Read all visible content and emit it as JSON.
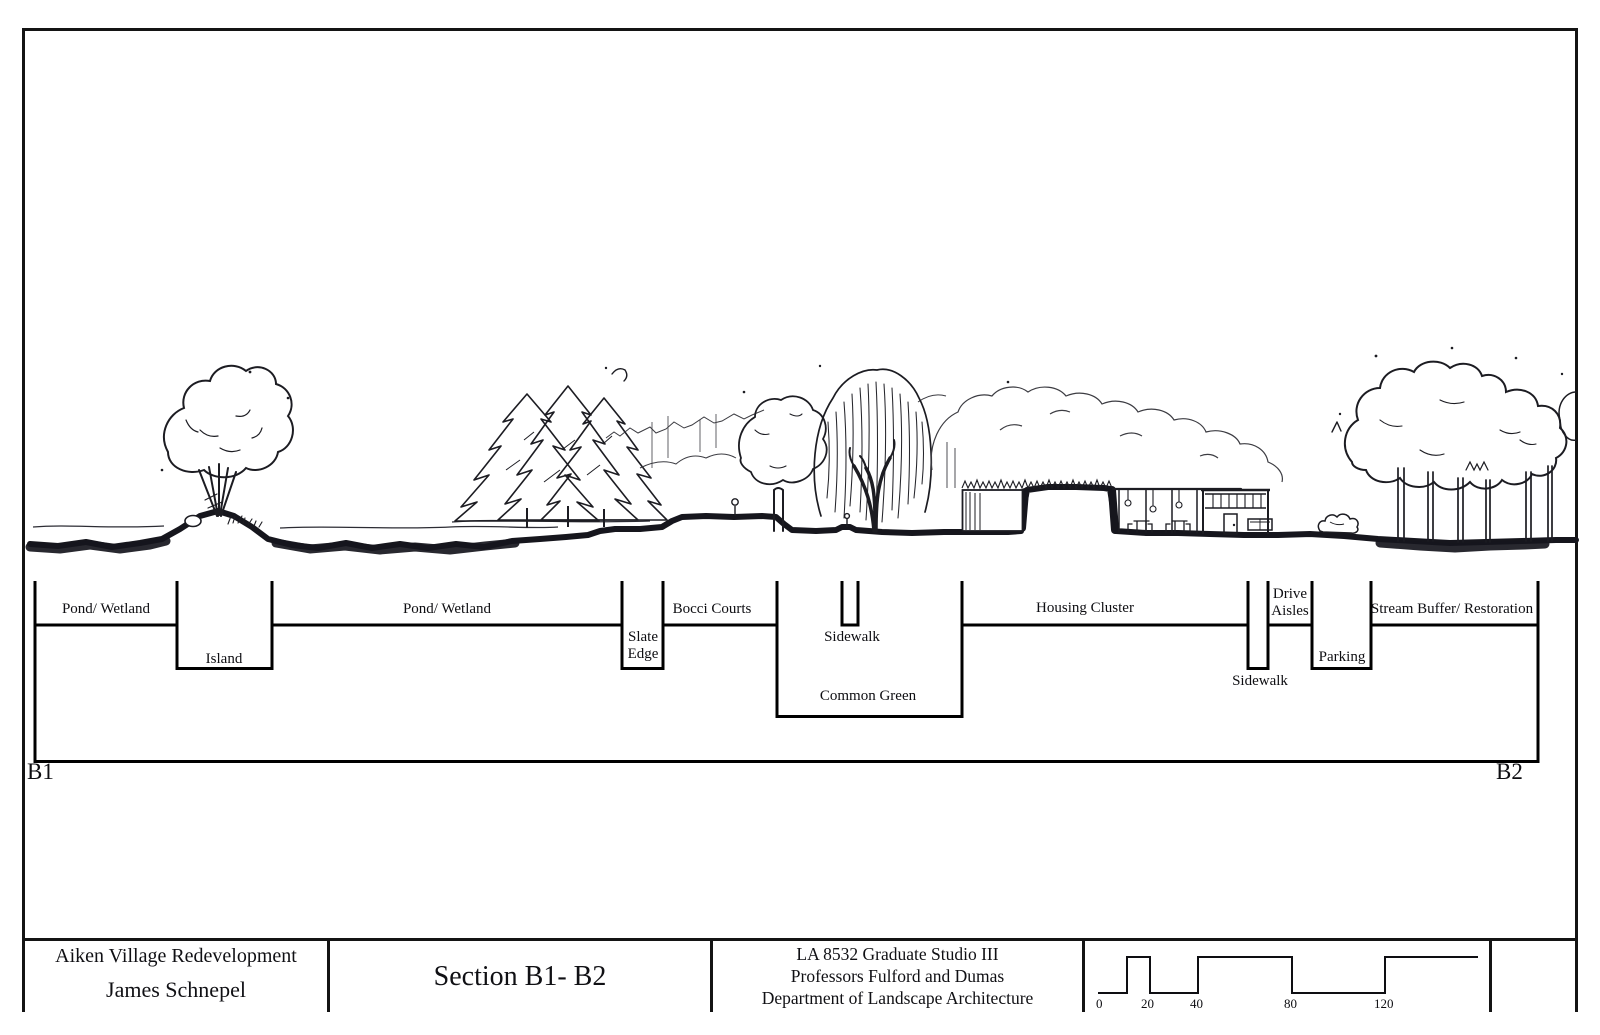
{
  "section": {
    "b1": "B1",
    "b2": "B2",
    "labels": {
      "pond_wetland_1": "Pond/ Wetland",
      "island": "Island",
      "pond_wetland_2": "Pond/ Wetland",
      "slate_edge_1": "Slate",
      "slate_edge_2": "Edge",
      "bocci_courts": "Bocci Courts",
      "sidewalk_upper": "Sidewalk",
      "common_green": "Common Green",
      "housing_cluster": "Housing Cluster",
      "sidewalk_lower": "Sidewalk",
      "drive_aisles_1": "Drive",
      "drive_aisles_2": "Aisles",
      "parking": "Parking",
      "stream_buffer": "Stream Buffer/ Restoration"
    }
  },
  "title_block": {
    "project": "Aiken Village Redevelopment",
    "designer": "James Schnepel",
    "sheet_title": "Section B1- B2",
    "course": "LA 8532 Graduate Studio III",
    "professors": "Professors Fulford and Dumas",
    "department": "Department of Landscape Architecture",
    "scale_ticks": [
      "0",
      "20",
      "40",
      "80",
      "120"
    ]
  },
  "colors": {
    "ink": "#16161d",
    "paper": "#ffffff"
  }
}
